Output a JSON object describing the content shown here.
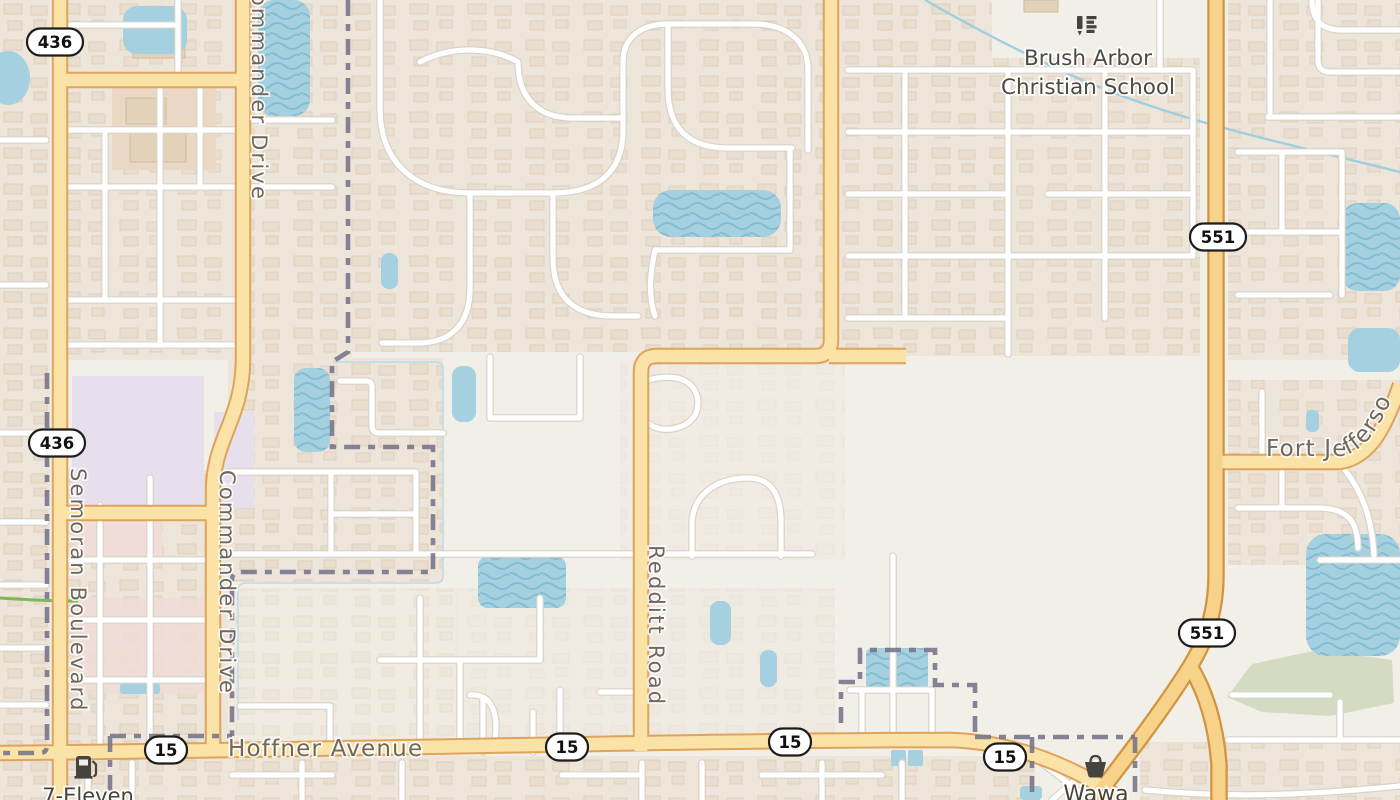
{
  "map": {
    "background": "#f2efe9",
    "shields": [
      {
        "label": "436"
      },
      {
        "label": "436"
      },
      {
        "label": "551"
      },
      {
        "label": "551"
      },
      {
        "label": "15"
      },
      {
        "label": "15"
      },
      {
        "label": "15"
      },
      {
        "label": "15"
      }
    ],
    "roads": {
      "semoran": "Semoran Boulevard",
      "commander_north": "Commander Drive",
      "commander_south": "Commander Drive",
      "redditt": "Redditt Road",
      "hoffner": "Hoffner Avenue",
      "fort_jefferson": "Fort Jefferson"
    },
    "pois": {
      "school": {
        "line1": "Brush Arbor",
        "line2": "Christian School",
        "icon": "school-icon"
      },
      "seven_eleven": {
        "label": "7-Eleven",
        "icon": "fuel-icon"
      },
      "wawa": {
        "label": "Wawa",
        "icon": "basket-icon"
      }
    },
    "colors": {
      "background": "#f2efe9",
      "primary_road_fill": "#fbe3a8",
      "primary_road_casing": "#dfa35c",
      "highway_551_fill": "#f6d28b",
      "water": "#a5d0df",
      "boundary": "#75738a",
      "residential": "#ece3d6",
      "industrial": "#e8dfec",
      "commercial_pink": "#f0ddd7",
      "road_label": "#6e685c",
      "poi_label": "#45433c"
    }
  }
}
